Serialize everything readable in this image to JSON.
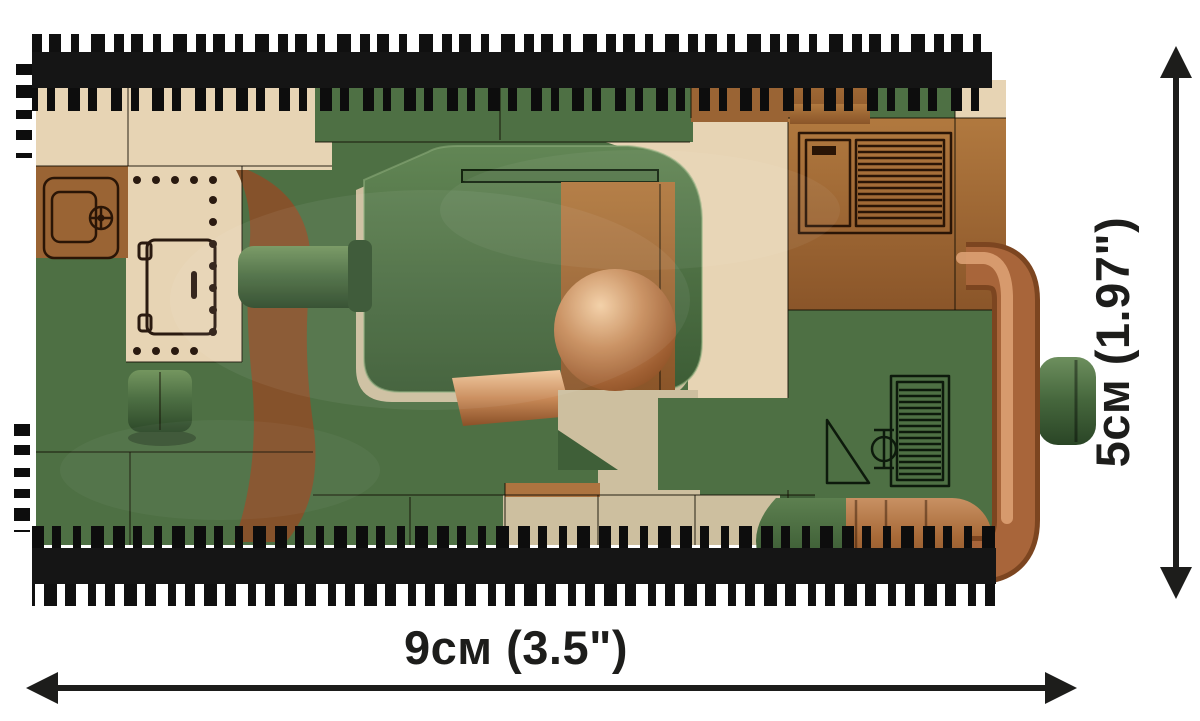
{
  "figure": {
    "type": "product-dimension-diagram",
    "subject": "COBI brick tank, top view"
  },
  "diagram": {
    "width_label": "9см (3.5\")",
    "height_label": "5см (1.97\")"
  },
  "dimensions": {
    "width_cm": 9,
    "width_in": 3.5,
    "height_cm": 5,
    "height_in": 1.97
  },
  "colors": {
    "green": "#4e7044",
    "greenLight": "#5f8453",
    "greenDark": "#3f5f38",
    "greenDeep": "#2e4a29",
    "tan": "#e7d4b4",
    "tanDark": "#cdbf9f",
    "tanDeep": "#b9ab8a",
    "brown": "#9a6434",
    "brownLight": "#ad7440",
    "brownDark": "#7c4d27",
    "copper": "#b97a4e",
    "copperHi": "#ecc29b",
    "copperDark": "#8a5128",
    "track": "#131313",
    "stud": "#0d0d0d",
    "label": "#1d1d1b",
    "bg": "#ffffff"
  }
}
